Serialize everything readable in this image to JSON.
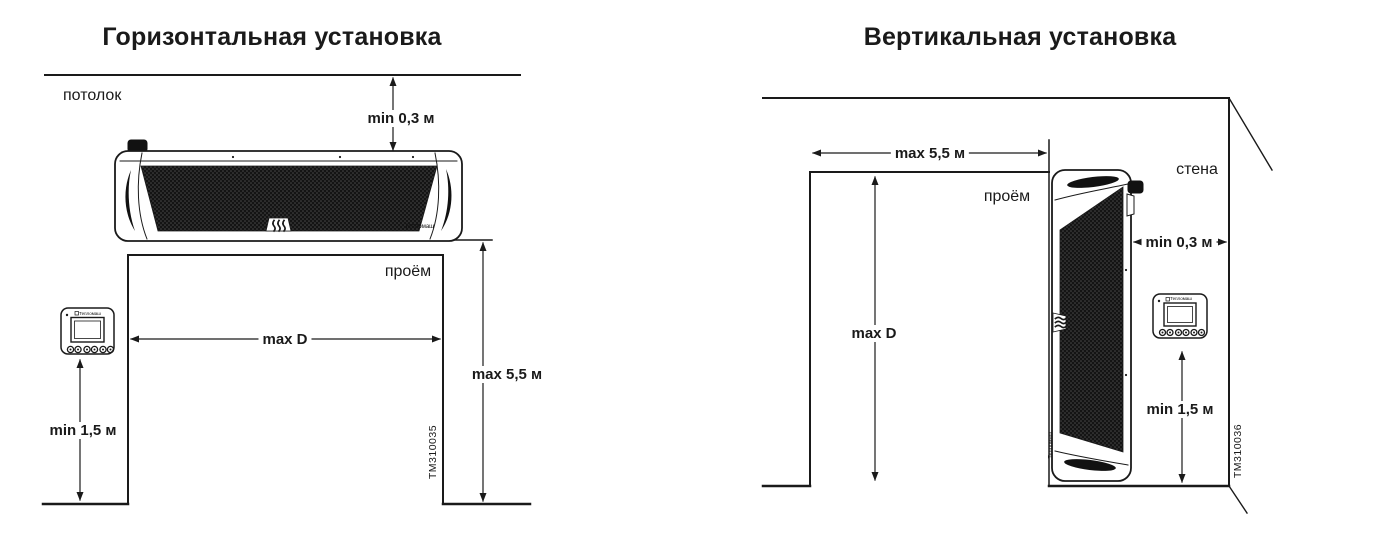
{
  "colors": {
    "line": "#1a1a1a",
    "grille": "#141414",
    "background": "#ffffff"
  },
  "horizontal": {
    "title": "Горизонтальная установка",
    "ceiling_label": "потолок",
    "opening_label": "проём",
    "dim_ceiling_gap": "min 0,3 м",
    "dim_opening_width": "max D",
    "dim_mount_height": "max 5,5 м",
    "dim_remote_height": "min 1,5 м",
    "drawing_number": "ТМ310035",
    "device_logo": "Тепломаш",
    "remote_logo": "Тепломаш"
  },
  "vertical": {
    "title": "Вертикальная установка",
    "wall_label": "стена",
    "opening_label": "проём",
    "dim_opening_width": "max 5,5 м",
    "dim_wall_gap": "min 0,3 м",
    "dim_opening_height": "max D",
    "dim_remote_height": "min 1,5 м",
    "drawing_number": "ТМ310036",
    "device_logo": "Тепломаш",
    "remote_logo": "Тепломаш"
  }
}
